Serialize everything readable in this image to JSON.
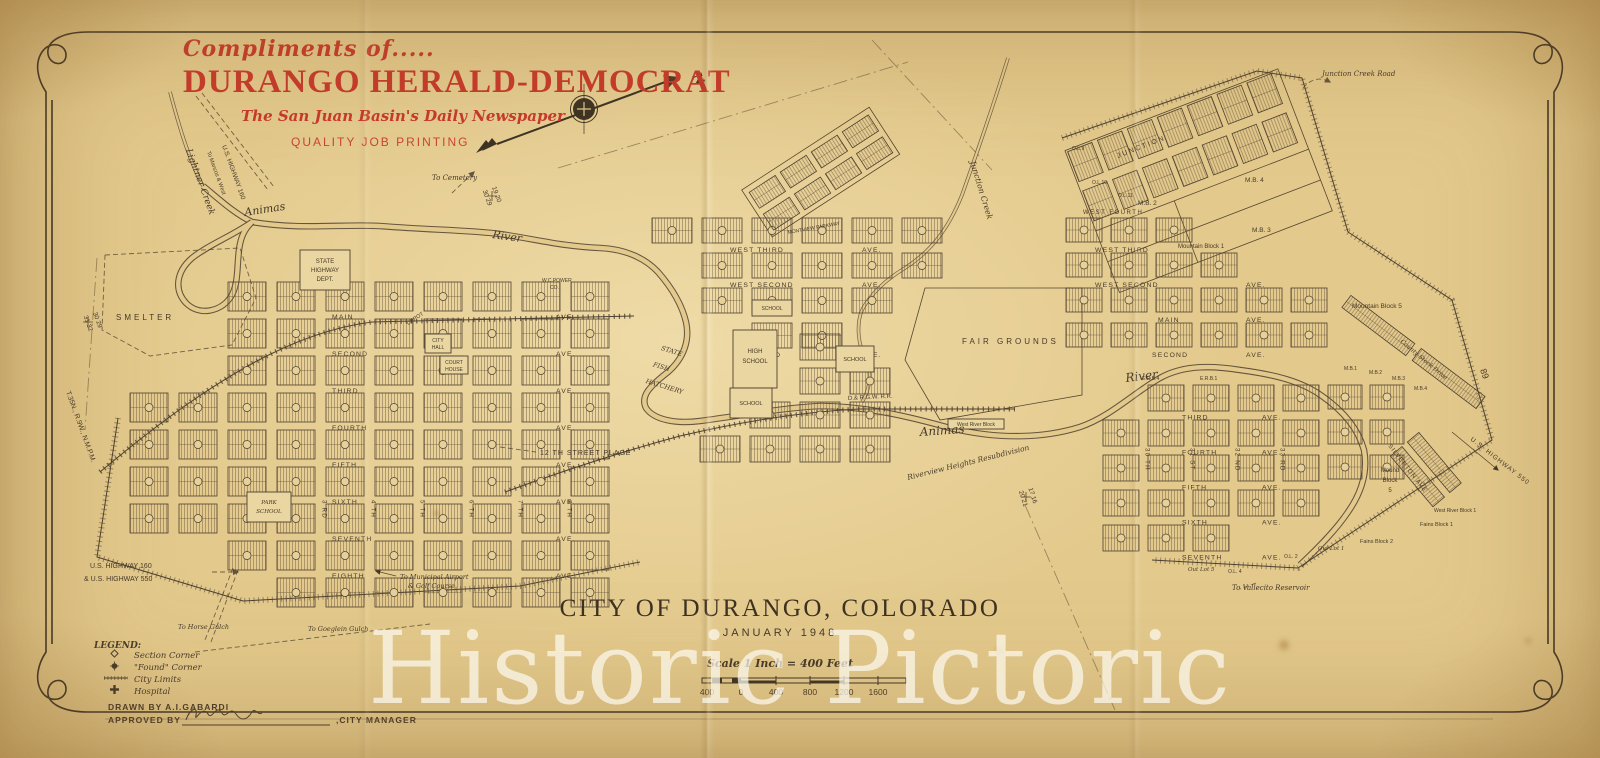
{
  "masthead": {
    "compliments": "Compliments of.....",
    "paper_name": "DURANGO HERALD-DEMOCRAT",
    "tagline": "The San Juan Basin's Daily Newspaper",
    "printing": "QUALITY JOB PRINTING"
  },
  "compass": {
    "north_label": "N"
  },
  "title_block": {
    "title": "CITY OF DURANGO, COLORADO",
    "date": "JANUARY 1948",
    "scale_text": "Scale  1 Inch = 400 Feet",
    "scale_ticks": [
      "400",
      "0",
      "400",
      "800",
      "1200",
      "1600"
    ]
  },
  "legend": {
    "heading": "LEGEND:",
    "items": [
      {
        "symbol": "section-corner",
        "label": "Section Corner"
      },
      {
        "symbol": "found-corner",
        "label": "\"Found\" Corner"
      },
      {
        "symbol": "city-limits",
        "label": "City Limits"
      },
      {
        "symbol": "hospital",
        "label": "Hospital"
      }
    ]
  },
  "credits": {
    "drawn_by": "DRAWN BY  A.I.GABARDI",
    "approved_by": "APPROVED BY",
    "approved_suffix": ",CITY MANAGER"
  },
  "watermark": "Historic Pictoric",
  "colors": {
    "paper": "#e3c98c",
    "ink": "#46392a",
    "masthead_red": "#c8392b",
    "watermark": "rgba(252,249,240,0.72)"
  },
  "map": {
    "street_names": {
      "west_avenues": [
        "MAIN",
        "SECOND",
        "THIRD",
        "FOURTH",
        "FIFTH",
        "SIXTH",
        "SEVENTH",
        "EIGHTH"
      ],
      "west_streets": [
        "2 ND",
        "3 RD",
        "4 TH",
        "5 TH",
        "6 TH",
        "7 TH",
        "8 TH"
      ],
      "ave": "AVE.",
      "central_avenues": [
        "WEST  THIRD",
        "WEST  SECOND",
        "",
        "SECOND"
      ],
      "ne_avenues": [
        "WEST  THIRD",
        "WEST  SECOND",
        "MAIN",
        "SECOND"
      ],
      "east_avenues": [
        "THIRD",
        "FOURTH",
        "FIFTH",
        "SIXTH",
        "SEVENTH"
      ],
      "east_streets": [
        "30 TH",
        "31 ST",
        "32 ND",
        "33 RD"
      ]
    },
    "labels": {
      "lightner": "Lightner Creek",
      "to_mancos": "To Mancos & West",
      "us160_v": "U.S. HIGHWAY 160",
      "animas_w": "Animas",
      "river_w": "River",
      "to_cemetery": "To Cemetery",
      "smelter": "SMELTER",
      "township": "T.35N., R.9W., N.M.P.M.",
      "sec_a1": "30 29",
      "sec_a2": "31 32",
      "sec_b1": "19 20",
      "sec_b2": "30 29",
      "sec_c1": "17 16",
      "sec_c2": "20 21",
      "sec_89": "89",
      "hwy_dept_1": "STATE",
      "hwy_dept_2": "HIGHWAY",
      "hwy_dept_3": "DEPT.",
      "depot": "DEPOT",
      "power_1": "W.C.POWER",
      "power_2": "CO.",
      "city_hall_1": "CITY",
      "city_hall_2": "HALL",
      "court_1": "COURT",
      "court_2": "HOUSE",
      "high_school_1": "HIGH",
      "school": "SCHOOL",
      "park_1": "PARK",
      "fish_1": "STATE",
      "fish_2": "FISH",
      "fish_3": "HATCHERY",
      "montview": "MONTVIEW  PARKWAY",
      "twelfth": "12 TH  STREET  PLACE",
      "fair_grounds": "FAIR  GROUNDS",
      "animas_e": "Animas",
      "river_e": "River",
      "rr": "D.& R.G.W.  R.R.",
      "west_river_block": "West River Block",
      "riverview": "Riverview  Heights  Resubdivision",
      "junction_creek": "Junction Creek",
      "junction_st": "JUNCTION",
      "junction_creek_road": "Junction Creek Road",
      "mb2": "M.B. 2",
      "mb3": "M.B. 3",
      "mb4": "M.B. 4",
      "mountain_block_1": "Mountain Block 1",
      "mountain_block_5": "Mountain Block 5",
      "ol9": "O.L.9",
      "ol10": "O.L.10",
      "ol11": "O.L.11",
      "west_fourth": "WEST  FOURTH",
      "county_stock": "County Stock Drive",
      "us550": "U.S. HIGHWAY 550",
      "mb1s": "M.B.1",
      "mb2s": "M.B.2",
      "mb3s": "M.B.3",
      "mb4s": "M.B.4",
      "silverton": "SILVERTON  AVE",
      "mound_1": "Mound",
      "mound_2": "Block",
      "mound_3": "5",
      "fains1": "Fains Block 1",
      "fains2": "Fains Block 2",
      "west_river_block_1": "West River Block 1",
      "out_lot_1": "Out Lot 1",
      "ol2": "O.L. 2",
      "out_lot_5": "Out Lot 5",
      "ol4": "O.L. 4",
      "to_vallecito": "To Vallecito Reservoir",
      "to_horse": "To Horse Gulch",
      "to_goeglein": "To Goeglein Gulch",
      "to_airport_1": "To Municipal Airport",
      "to_airport_2": "& Golf Course",
      "us160_550_1": "U.S. HIGHWAY 160",
      "us160_550_2": "& U.S. HIGHWAY 550",
      "erb4": "E.R.B.4",
      "erb1": "E.R.B.1"
    }
  }
}
